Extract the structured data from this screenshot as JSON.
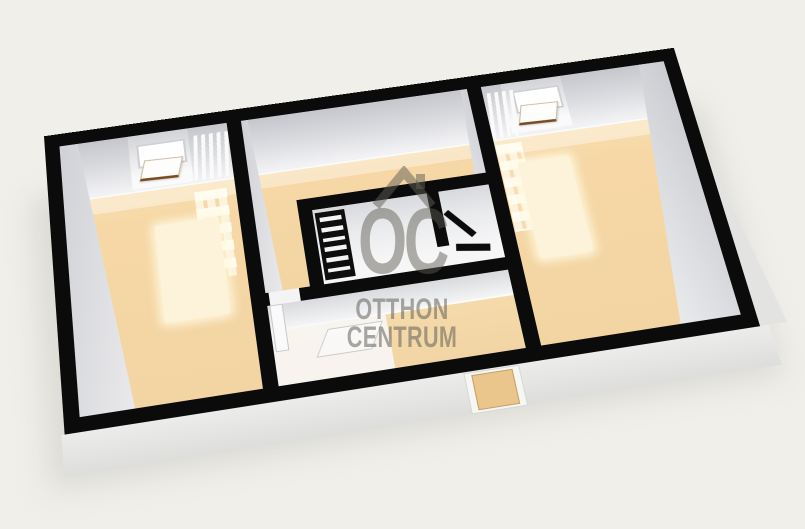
{
  "meta": {
    "description": "3D rendered real-estate floor plan with watermark",
    "background_color": "#f0efea"
  },
  "watermark": {
    "logo": "OC",
    "line1": "OTTHON",
    "line2": "CENTRUM",
    "house_icon": "roof-with-chimney",
    "color": "rgba(95,93,85,0.5)"
  },
  "palette": {
    "wall_top": "#0b0b0b",
    "wall_inner_face": "#d8d9dd",
    "floor": "#f6d7a5",
    "rug": "#fcf3da",
    "sunlight_patch": "#fff6dd",
    "exterior_face": "#e4e4e2",
    "entry_door": "#eac68c",
    "bathroom_floor": "#efeff1"
  },
  "plan": {
    "rooms": [
      {
        "name": "left-room",
        "floor": "orange",
        "features": [
          "window-open-sash",
          "radiator",
          "rug",
          "sunlight-patches"
        ]
      },
      {
        "name": "middle-room",
        "floor": "orange",
        "features": [
          "shelf-unit"
        ]
      },
      {
        "name": "bathroom",
        "floor": "white",
        "features": [
          "partition-wall",
          "door-ajar"
        ]
      },
      {
        "name": "hallway",
        "floor": "orange-white",
        "features": [
          "entry-door",
          "open-white-door"
        ]
      },
      {
        "name": "right-room",
        "floor": "orange",
        "features": [
          "window-open-sash",
          "radiator",
          "rug",
          "sunlight-patches"
        ]
      }
    ]
  }
}
